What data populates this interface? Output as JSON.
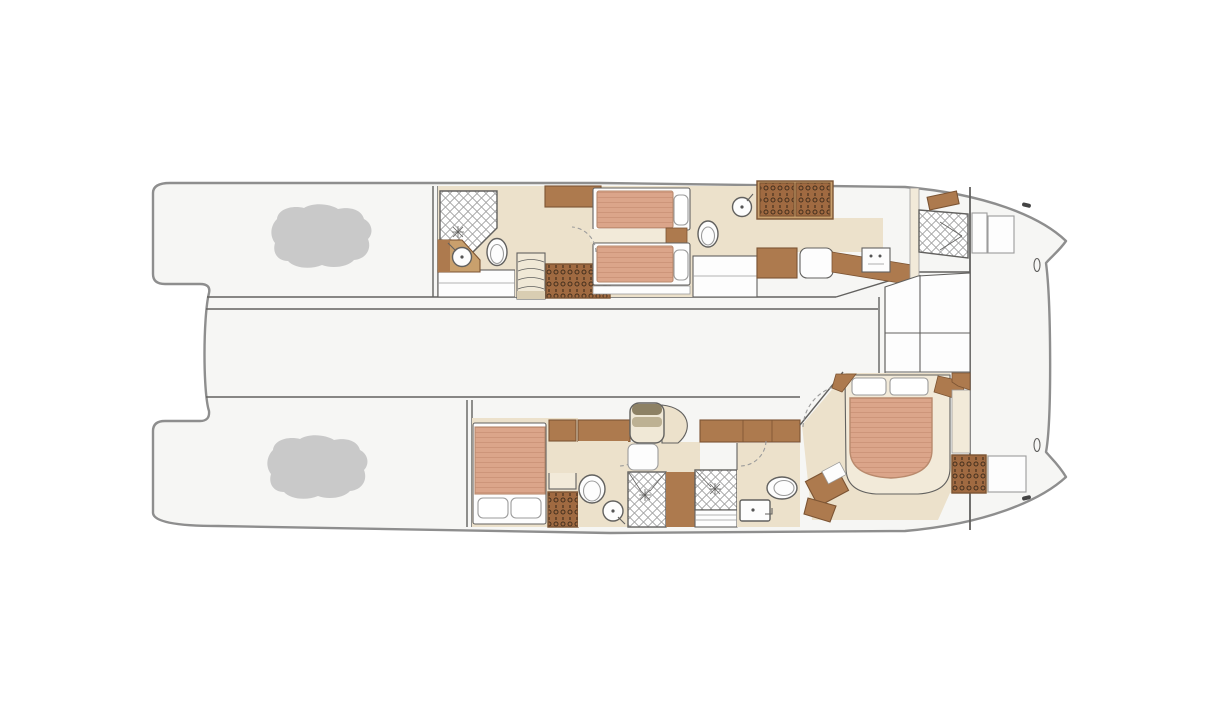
{
  "meta": {
    "canvas_width": 1224,
    "canvas_height": 720,
    "diagram_kind": "catamaran-yacht-lower-deck-floor-plan"
  },
  "colors": {
    "page_bg": "#ffffff",
    "hull_fill": "#f6f6f4",
    "hull_stroke": "#8e8e8e",
    "line": "#62615f",
    "line_soft": "#9b9b9b",
    "floor": "#ece1cb",
    "floor_light": "#f2ead9",
    "wood_mid": "#ad7a4e",
    "wood_dark": "#7c5433",
    "wood_light": "#c9a06d",
    "wardrobe": "#a06a41",
    "hanger_mark": "#46301d",
    "mattress": "#dba58a",
    "mattress_stripe": "#cd957a",
    "mattress_edge": "#b98a6d",
    "pillow": "#ffffff",
    "tile_line": "#9a9a9a",
    "blob": "#c9c9c9",
    "stair": "#f0e8d6"
  },
  "rooms": [
    {
      "name": "port-aft-platform",
      "features": [
        "tender-outline"
      ]
    },
    {
      "name": "port-guest-bathroom-aft",
      "features": [
        "shower",
        "vanity-sink",
        "toilet"
      ]
    },
    {
      "name": "port-twin-guest-cabin",
      "features": [
        "single-bed",
        "single-bed",
        "wardrobe",
        "stairs",
        "cabinet",
        "nightstand"
      ]
    },
    {
      "name": "port-guest-bathroom-forward",
      "features": [
        "toilet",
        "sink",
        "cabinets"
      ]
    },
    {
      "name": "port-corridor",
      "features": [
        "hanging-lockers",
        "dresser",
        "seat",
        "appliance",
        "counter"
      ]
    },
    {
      "name": "crew-cabin-forward",
      "features": [
        "berth",
        "pillow",
        "anchor-lockers"
      ]
    },
    {
      "name": "bridgedeck-walkway",
      "features": []
    },
    {
      "name": "owner-forward-closets",
      "features": [
        "closet-panels"
      ]
    },
    {
      "name": "starboard-aft-platform",
      "features": [
        "tender-outline"
      ]
    },
    {
      "name": "starboard-double-guest-cabin",
      "features": [
        "double-bed",
        "wardrobe",
        "cabinet",
        "tall-unit"
      ]
    },
    {
      "name": "starboard-guest-bathroom",
      "features": [
        "toilet",
        "sink",
        "shower"
      ]
    },
    {
      "name": "midship-stairs",
      "features": [
        "curved-stair"
      ]
    },
    {
      "name": "second-shower-room",
      "features": [
        "shower",
        "steps"
      ]
    },
    {
      "name": "owner-bathroom",
      "features": [
        "toilet",
        "sink",
        "cabinet-row"
      ]
    },
    {
      "name": "owner-stateroom",
      "features": [
        "island-double-bed",
        "desk",
        "stool",
        "wardrobe",
        "locker",
        "closets"
      ]
    }
  ]
}
